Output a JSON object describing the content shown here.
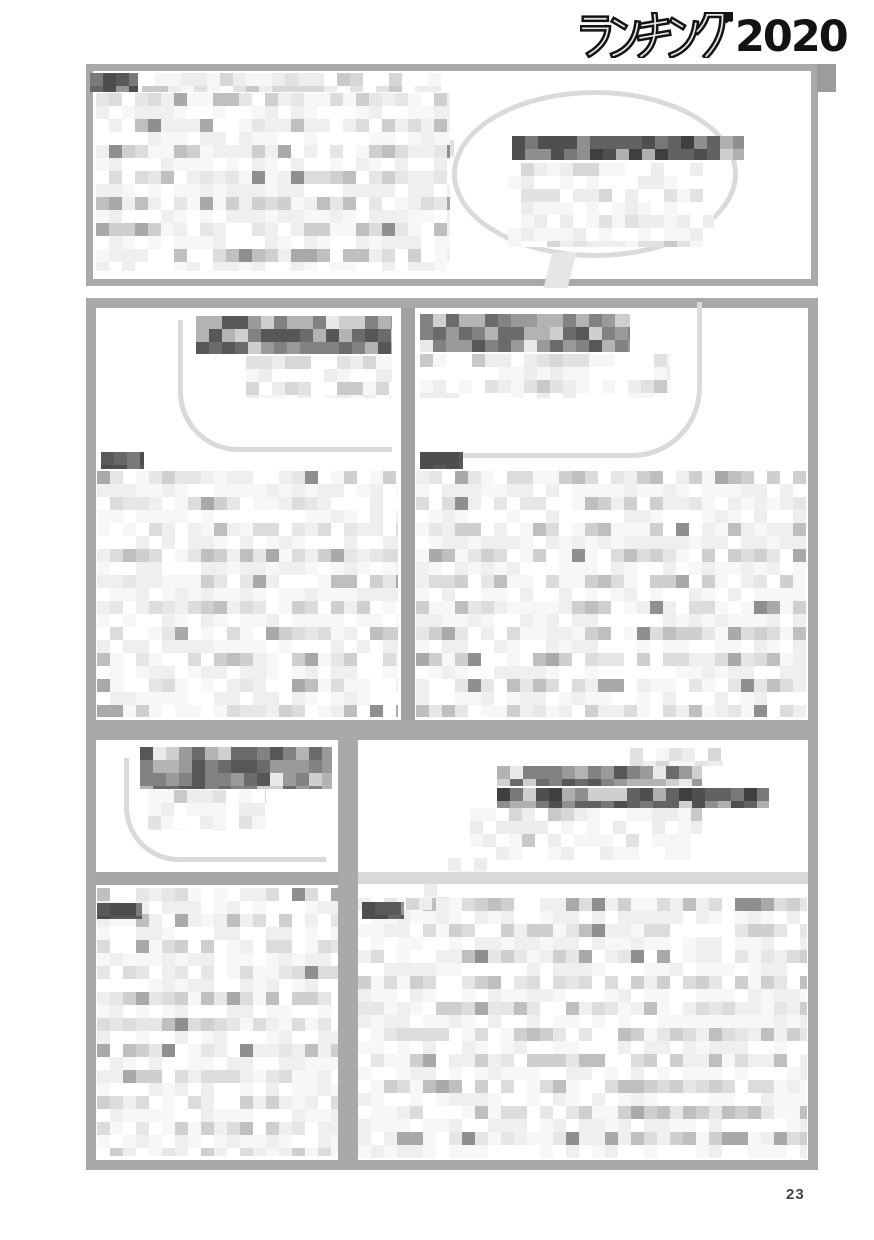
{
  "header": {
    "logo_kana": "ランキング",
    "logo_year": "2020"
  },
  "page": {
    "number": "23"
  },
  "colors": {
    "box_border": "#a9a9a9",
    "divider": "#a2a2a2",
    "light_divider": "#d9d9d9",
    "header_rule": "#c6c6c6",
    "header_rule_cap": "#9c9c9c",
    "bubble_outline": "#dadada",
    "logo_ink": "#131313",
    "page_number_ink": "#454545"
  },
  "palettes": {
    "body": {
      "colors": [
        "#ffffff",
        "#f7f7f7",
        "#efefef",
        "#e6e6e6",
        "#dcdcdc",
        "#cfcfcf",
        "#bfbfbf",
        "#a9a9a9",
        "#8f8f8f"
      ],
      "weights": [
        16,
        15,
        14,
        13,
        11,
        9,
        7,
        4,
        2
      ]
    },
    "soft": {
      "colors": [
        "#ffffff",
        "#f6f6f6",
        "#ededed",
        "#e2e2e2",
        "#d7d7d7",
        "#c9c9c9"
      ],
      "weights": [
        18,
        14,
        12,
        9,
        6,
        4
      ]
    },
    "headline": {
      "colors": [
        "#e9e9e9",
        "#cfcfcf",
        "#b3b3b3",
        "#9a9a9a",
        "#828282",
        "#6b6b6b",
        "#575757"
      ],
      "weights": [
        6,
        9,
        12,
        16,
        18,
        14,
        8
      ]
    },
    "headline_dark": {
      "colors": [
        "#cfcfcf",
        "#b0b0b0",
        "#8f8f8f",
        "#787878",
        "#626262",
        "#4f4f4f",
        "#3f3f3f"
      ],
      "weights": [
        5,
        8,
        12,
        16,
        18,
        14,
        8
      ]
    },
    "label": {
      "colors": [
        "#4d4d4d",
        "#595959",
        "#676767",
        "#7a7a7a",
        "#969696"
      ],
      "weights": [
        8,
        6,
        3,
        2,
        1
      ]
    }
  },
  "censored_regions": {
    "intro_label": {
      "l": 90,
      "t": 73,
      "w": 48,
      "h": 19,
      "cell": 13,
      "p": "label",
      "seed": 11,
      "z": 4
    },
    "intro_toprow": {
      "l": 142,
      "t": 73,
      "w": 300,
      "h": 19,
      "cell": 13,
      "p": "soft",
      "seed": 12
    },
    "intro_body": {
      "l": 96,
      "t": 93,
      "w": 354,
      "h": 178,
      "cell": 13,
      "p": "body",
      "band": true,
      "seed": 13
    },
    "intro_bubble_text": {
      "l": 512,
      "t": 136,
      "w": 232,
      "h": 24,
      "cell": 13,
      "p": "headline_dark",
      "seed": 14
    },
    "intro_bubble_soft": {
      "l": 508,
      "t": 163,
      "w": 206,
      "h": 84,
      "cell": 13,
      "p": "soft",
      "band": true,
      "seed": 15
    },
    "col1_headline": {
      "l": 196,
      "t": 316,
      "w": 196,
      "h": 38,
      "cell": 13,
      "p": "headline",
      "seed": 21
    },
    "col1_sub": {
      "l": 246,
      "t": 356,
      "w": 146,
      "h": 42,
      "cell": 13,
      "p": "soft",
      "band": true,
      "seed": 22
    },
    "col1_label": {
      "l": 101,
      "t": 452,
      "w": 43,
      "h": 17,
      "cell": 13,
      "p": "label",
      "seed": 23,
      "z": 4
    },
    "col1_body": {
      "l": 97,
      "t": 471,
      "w": 301,
      "h": 246,
      "cell": 13,
      "p": "body",
      "band": true,
      "seed": 24
    },
    "col2_headline": {
      "l": 420,
      "t": 314,
      "w": 210,
      "h": 38,
      "cell": 13,
      "p": "headline",
      "seed": 31
    },
    "col2_sub": {
      "l": 420,
      "t": 354,
      "w": 250,
      "h": 44,
      "cell": 13,
      "p": "soft",
      "band": true,
      "seed": 32
    },
    "col2_label": {
      "l": 420,
      "t": 452,
      "w": 43,
      "h": 17,
      "cell": 13,
      "p": "label",
      "seed": 33,
      "z": 4
    },
    "col2_body": {
      "l": 416,
      "t": 471,
      "w": 390,
      "h": 246,
      "cell": 13,
      "p": "body",
      "band": true,
      "seed": 34
    },
    "b1_headline": {
      "l": 140,
      "t": 747,
      "w": 192,
      "h": 42,
      "cell": 13,
      "p": "headline",
      "seed": 41
    },
    "b1_sub": {
      "l": 148,
      "t": 790,
      "w": 118,
      "h": 40,
      "cell": 13,
      "p": "soft",
      "band": true,
      "seed": 42
    },
    "b1_label": {
      "l": 97,
      "t": 903,
      "w": 45,
      "h": 16,
      "cell": 13,
      "p": "label",
      "seed": 43,
      "z": 4
    },
    "b1_body": {
      "l": 97,
      "t": 888,
      "w": 241,
      "h": 268,
      "cell": 13,
      "p": "body",
      "band": true,
      "seed": 44
    },
    "b2_head_light": {
      "l": 630,
      "t": 748,
      "w": 92,
      "h": 18,
      "cell": 13,
      "p": "soft",
      "seed": 51
    },
    "b2_headline_a": {
      "l": 497,
      "t": 766,
      "w": 205,
      "h": 20,
      "cell": 13,
      "p": "headline",
      "seed": 52
    },
    "b2_headline_b": {
      "l": 497,
      "t": 788,
      "w": 272,
      "h": 20,
      "cell": 13,
      "p": "headline_dark",
      "seed": 53
    },
    "b2_sub": {
      "l": 470,
      "t": 808,
      "w": 232,
      "h": 52,
      "cell": 13,
      "p": "soft",
      "band": true,
      "seed": 54
    },
    "b2_tail1": {
      "l": 448,
      "t": 858,
      "w": 46,
      "h": 14,
      "cell": 13,
      "p": "soft",
      "seed": 55,
      "z": 4
    },
    "b2_tail2": {
      "l": 424,
      "t": 884,
      "w": 32,
      "h": 14,
      "cell": 13,
      "p": "soft",
      "seed": 56,
      "z": 4
    },
    "b2_tail3": {
      "l": 406,
      "t": 898,
      "w": 26,
      "h": 12,
      "cell": 13,
      "p": "soft",
      "seed": 57,
      "z": 4
    },
    "b2_label": {
      "l": 362,
      "t": 902,
      "w": 42,
      "h": 17,
      "cell": 13,
      "p": "label",
      "seed": 58,
      "z": 4
    },
    "b2_body": {
      "l": 358,
      "t": 898,
      "w": 449,
      "h": 260,
      "cell": 13,
      "p": "body",
      "band": true,
      "seed": 59
    }
  }
}
